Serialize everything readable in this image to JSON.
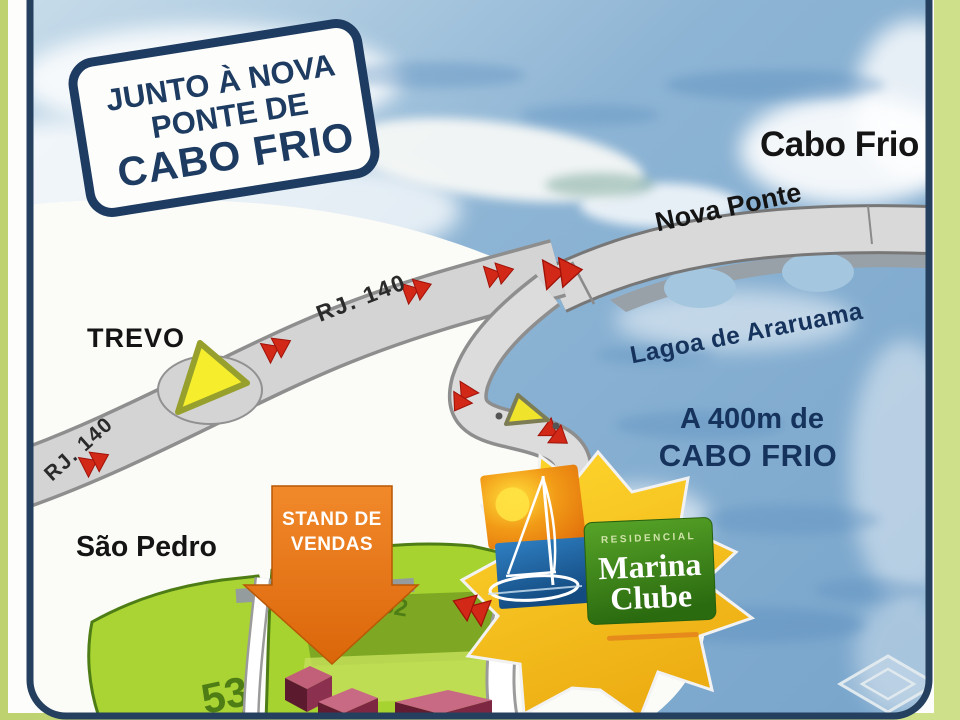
{
  "badge": {
    "line1": "JUNTO À NOVA",
    "line2": "PONTE DE",
    "line3": "CABO FRIO"
  },
  "labels": {
    "cabo_frio_city": "Cabo Frio",
    "nova_ponte": "Nova Ponte",
    "trevo": "TREVO",
    "rj140_left": "RJ. 140",
    "rj140_mid": "RJ. 140",
    "lagoa": "Lagoa de Araruama",
    "distance_line1": "A 400m de",
    "distance_line2": "CABO FRIO",
    "sao_pedro": "São Pedro"
  },
  "stand": {
    "line1": "STAND DE",
    "line2": "VENDAS"
  },
  "logo": {
    "residencial": "RESIDENCIAL",
    "name_line1": "Marina",
    "name_line2": "Clube"
  },
  "parcels": {
    "left_number": "53",
    "right_number": "52"
  },
  "colors": {
    "frame_green": "#c2d577",
    "frame_navy": "#24405e",
    "water": "#8db4d4",
    "land": "#fbfbf7",
    "road_gray": "#d4d4d4",
    "arrow_red": "#d22818",
    "stand_orange": "#ec7d12",
    "parcel_green": "#a6d32f",
    "parcel_line_green": "#4e7d15",
    "logo_yellow": "#ffd82e",
    "logo_blue": "#1a5a9a",
    "logo_green": "#3c8a1c",
    "text_navy": "#16355e",
    "text_black": "#141414",
    "building_maroon": "#611c32"
  }
}
